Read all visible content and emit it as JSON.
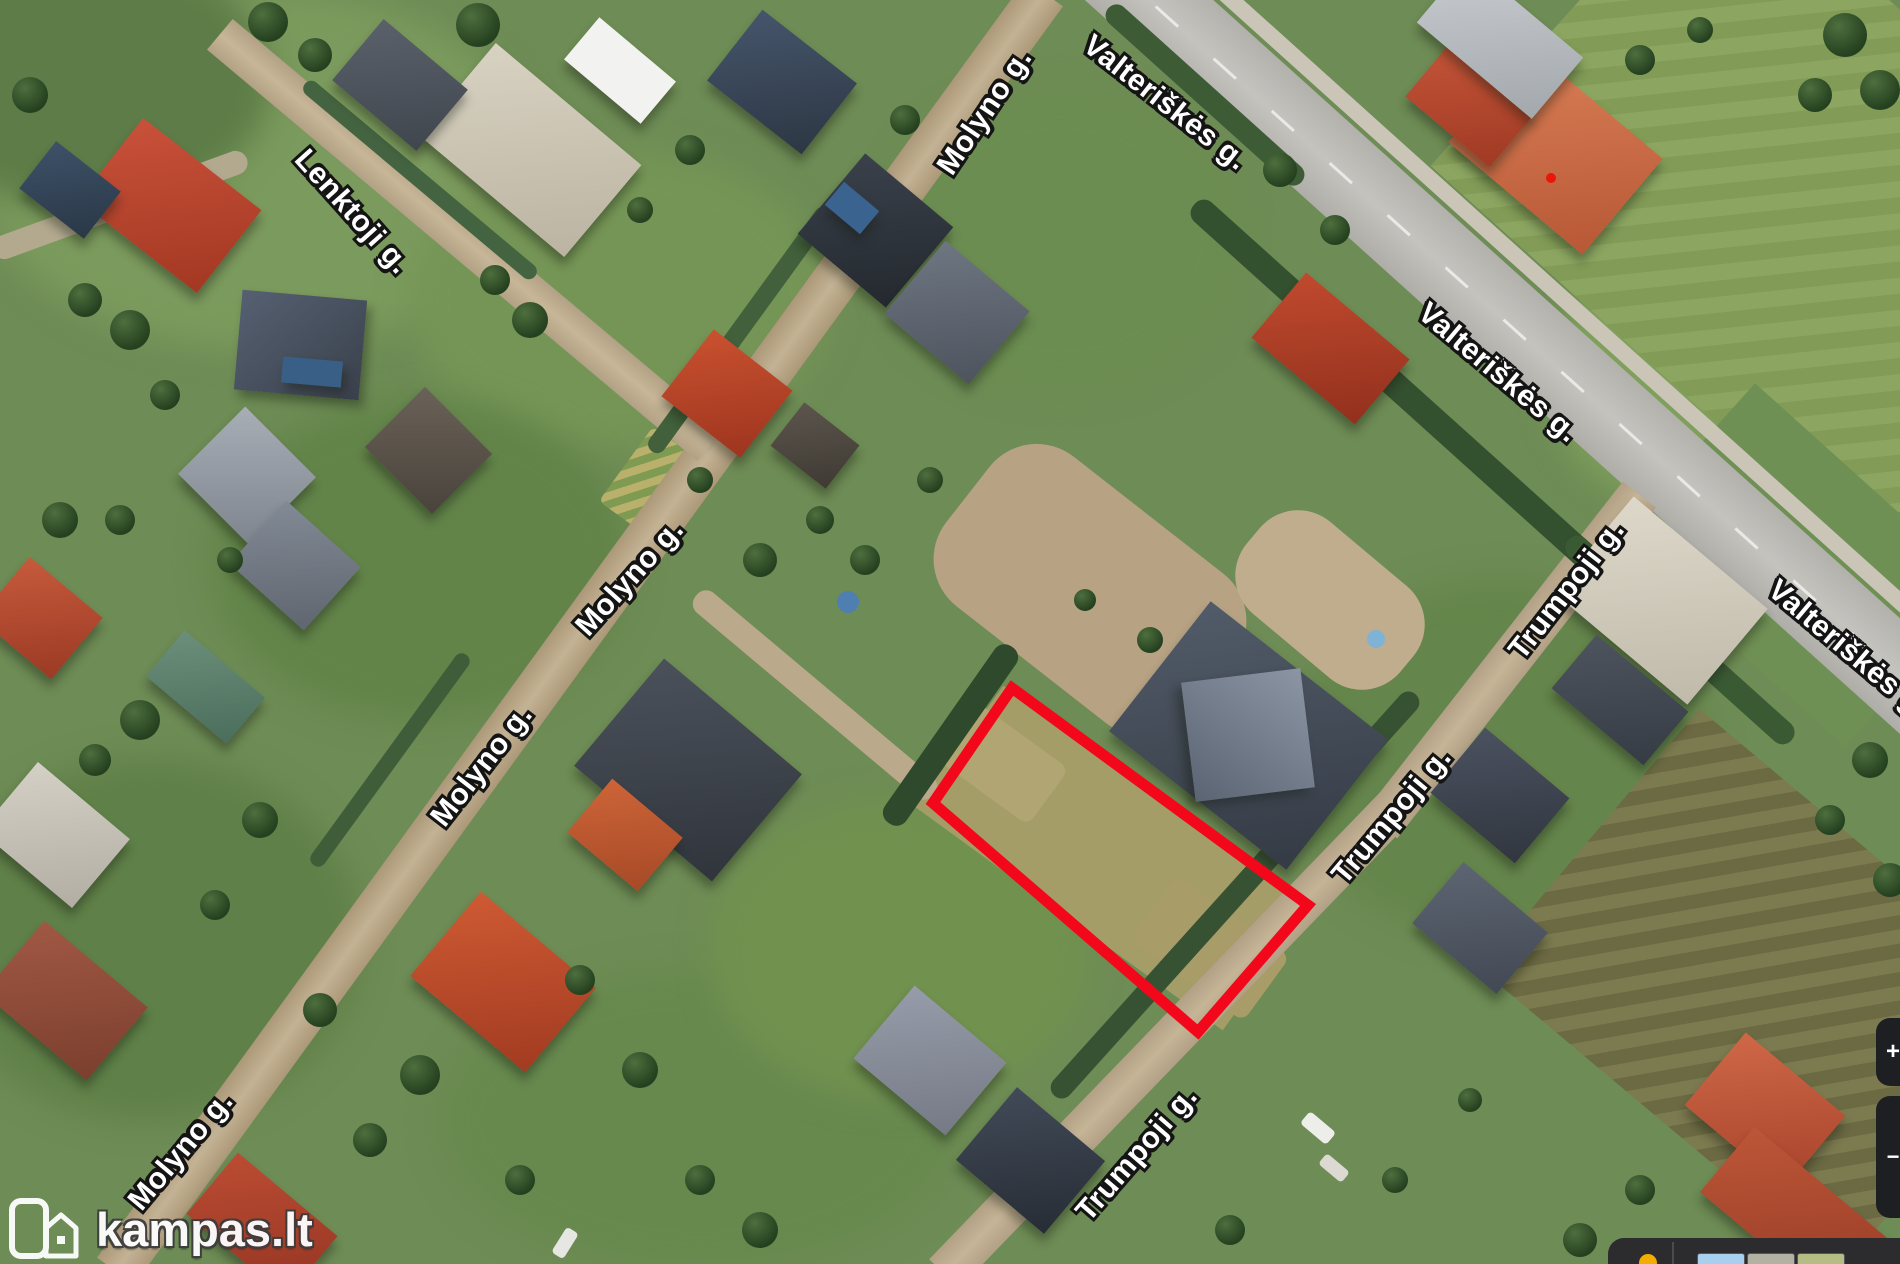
{
  "map": {
    "type": "satellite-view",
    "street_labels": [
      {
        "id": "lenktoji",
        "text": "Lenktoji g."
      },
      {
        "id": "molyno-top",
        "text": "Molyno g."
      },
      {
        "id": "valteriskes-top",
        "text": "Valteriškės g."
      },
      {
        "id": "valteriskes-mid",
        "text": "Valteriškės g."
      },
      {
        "id": "valteriskes-right",
        "text": "Valteriškės g."
      },
      {
        "id": "molyno-mid",
        "text": "Molyno g."
      },
      {
        "id": "molyno-left",
        "text": "Molyno g."
      },
      {
        "id": "molyno-bottom",
        "text": "Molyno g."
      },
      {
        "id": "trumpoji-top",
        "text": "Trumpoji g."
      },
      {
        "id": "trumpoji-mid",
        "text": "Trumpoji g."
      },
      {
        "id": "trumpoji-bottom",
        "text": "Trumpoji g."
      }
    ],
    "plot_outline_color": "#f2081a",
    "marker_dot_color": "#ea1508"
  },
  "watermark": {
    "text": "kampas.lt"
  },
  "controls": {
    "pin_color": "#f3ac00",
    "zoom_in_label": "+",
    "zoom_out_label": "−",
    "layer_thumbnail_colors": {
      "first": "#a8d0ee",
      "second": "#b3b2a2",
      "third": "#b6bd84"
    }
  }
}
